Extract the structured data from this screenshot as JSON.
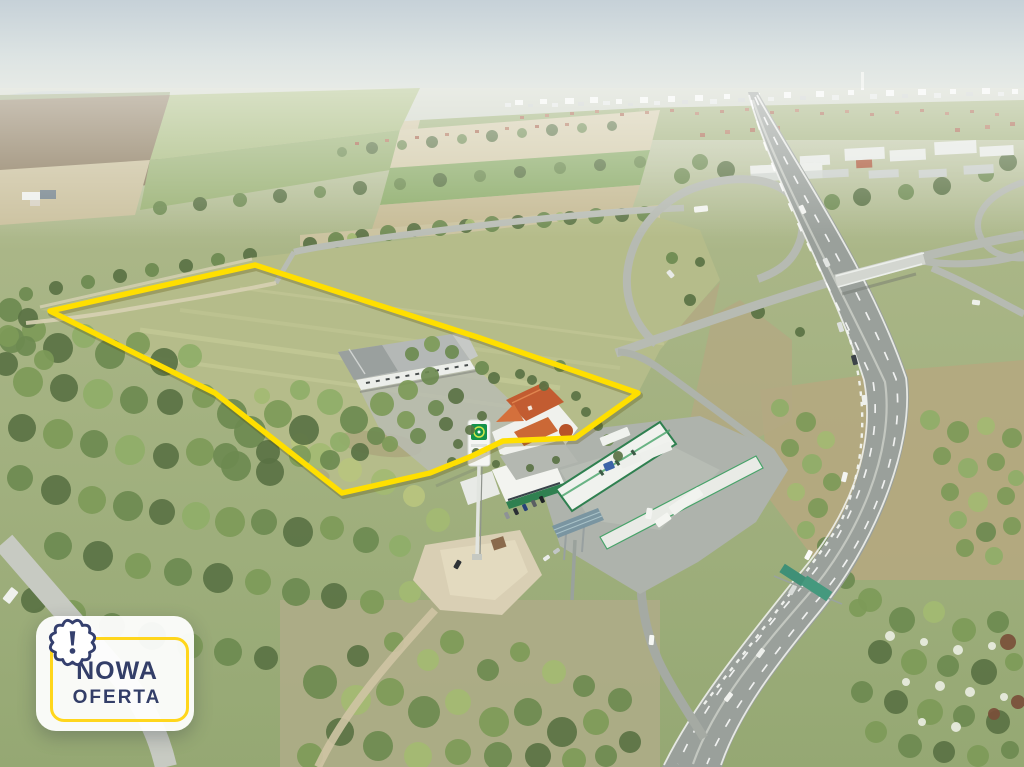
{
  "badge": {
    "line1": "NOWA",
    "line2": "OFERTA",
    "text_color": "#333e68",
    "border_color": "#ffd61c",
    "icon": "exclamation-seal-icon"
  },
  "plot": {
    "outline_points": "255,265 50,311 215,393 342,493 430,473 472,456 503,441 575,438 638,393 480,338",
    "outline_color": "#ffdf00"
  },
  "station": {
    "brand_color": "#13924a"
  }
}
